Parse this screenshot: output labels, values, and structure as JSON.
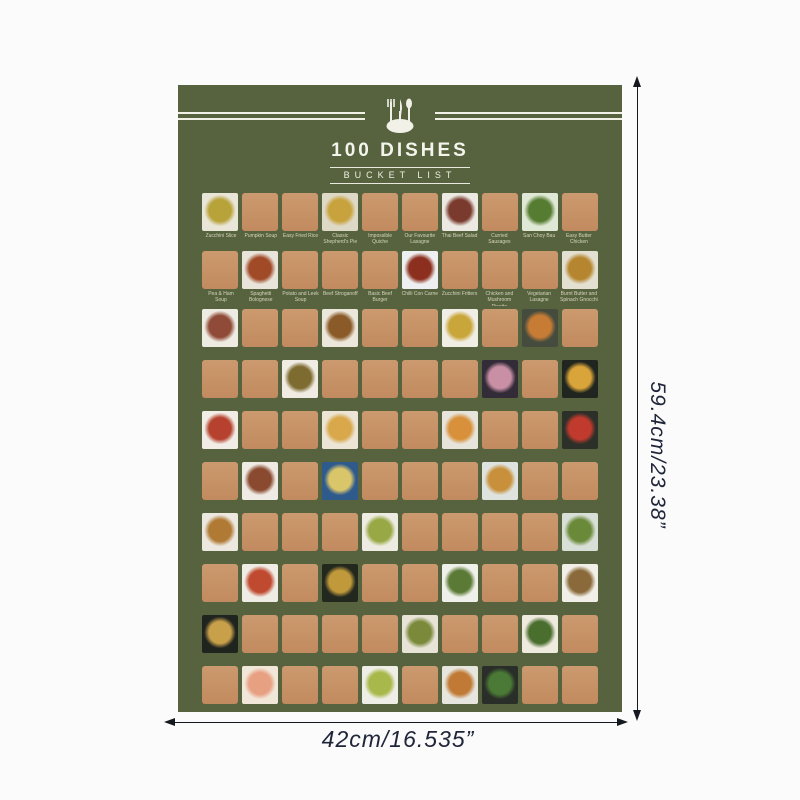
{
  "header": {
    "title": "100 DISHES",
    "subtitle": "BUCKET  LIST",
    "icon": "cutlery-plate-icon"
  },
  "annotations": {
    "height_label": "59.4cm/23.38”",
    "width_label": "42cm/16.535”"
  },
  "colors": {
    "poster_bg": "#57633f",
    "scratch": "#c28a5f",
    "label": "#d6d6bc",
    "annotation": "#20263a",
    "header_text": "#f4f4ec"
  },
  "grid": {
    "rows": [
      {
        "labeled": true,
        "cells": [
          {
            "t": "photo",
            "label": "Zucchini Slice",
            "desc": "zucchini-slice",
            "bg": "#e9e6d8",
            "food": "#b8a23a"
          },
          {
            "t": "scratch",
            "label": "Pumpkin Soup"
          },
          {
            "t": "scratch",
            "label": "Easy Fried Rice"
          },
          {
            "t": "photo",
            "label": "Classic Shepherd's Pie",
            "desc": "shepherds-pie",
            "bg": "#ded8c6",
            "food": "#c8a23c"
          },
          {
            "t": "scratch",
            "label": "Impossible Quiche"
          },
          {
            "t": "scratch",
            "label": "Our Favourite Lasagne"
          },
          {
            "t": "photo",
            "label": "Thai Beef Salad",
            "desc": "thai-beef-salad",
            "bg": "#ebe9e2",
            "food": "#7a3b2e"
          },
          {
            "t": "scratch",
            "label": "Curried Sausages"
          },
          {
            "t": "photo",
            "label": "San Choy Bau",
            "desc": "san-choy-bau",
            "bg": "#dfe8d4",
            "food": "#557c31"
          },
          {
            "t": "scratch",
            "label": "Easy Butter Chicken"
          }
        ]
      },
      {
        "labeled": true,
        "cells": [
          {
            "t": "scratch",
            "label": "Pea & Ham Soup"
          },
          {
            "t": "photo",
            "label": "Spaghetti Bolognese",
            "desc": "spaghetti-bolognese",
            "bg": "#e8e4da",
            "food": "#a04a28"
          },
          {
            "t": "scratch",
            "label": "Potato and Leek Soup"
          },
          {
            "t": "scratch",
            "label": "Beef Stroganoff"
          },
          {
            "t": "scratch",
            "label": "Basic Beef Burger"
          },
          {
            "t": "photo",
            "label": "Chilli Con Carne",
            "desc": "chilli-con-carne",
            "bg": "#edeff0",
            "food": "#8c2f1e"
          },
          {
            "t": "scratch",
            "label": "Zucchini Fritters"
          },
          {
            "t": "scratch",
            "label": "Chicken and Mushroom Risotto"
          },
          {
            "t": "scratch",
            "label": "Vegetarian Lasagne"
          },
          {
            "t": "photo",
            "label": "Burnt Butter and Spinach Gnocchi",
            "desc": "spinach-gnocchi",
            "bg": "#e3e0d2",
            "food": "#b5862f"
          }
        ]
      },
      {
        "labeled": false,
        "cells": [
          {
            "t": "photo",
            "desc": "garden-salad",
            "bg": "#eeebe2",
            "food": "#8f4a38"
          },
          {
            "t": "scratch"
          },
          {
            "t": "scratch"
          },
          {
            "t": "photo",
            "desc": "fried-noodles",
            "bg": "#ece7db",
            "food": "#8a5a28"
          },
          {
            "t": "scratch"
          },
          {
            "t": "scratch"
          },
          {
            "t": "photo",
            "desc": "corn-salad",
            "bg": "#f0ede4",
            "food": "#c9a63a"
          },
          {
            "t": "scratch"
          },
          {
            "t": "photo",
            "desc": "roast-veggie-bowl",
            "bg": "#454c3e",
            "food": "#c77c35"
          },
          {
            "t": "scratch"
          }
        ]
      },
      {
        "labeled": false,
        "cells": [
          {
            "t": "scratch"
          },
          {
            "t": "scratch"
          },
          {
            "t": "photo",
            "desc": "spaghetti-plate",
            "bg": "#f0ece4",
            "food": "#7d6b30"
          },
          {
            "t": "scratch"
          },
          {
            "t": "scratch"
          },
          {
            "t": "scratch"
          },
          {
            "t": "scratch"
          },
          {
            "t": "photo",
            "desc": "berry-cheesecake",
            "bg": "#332c38",
            "food": "#c98fa5"
          },
          {
            "t": "scratch"
          },
          {
            "t": "photo",
            "desc": "loaded-nacho-pan",
            "bg": "#20261f",
            "food": "#d9a43a"
          }
        ]
      },
      {
        "labeled": false,
        "cells": [
          {
            "t": "photo",
            "desc": "meat-platter",
            "bg": "#f1ede6",
            "food": "#b5412e"
          },
          {
            "t": "scratch"
          },
          {
            "t": "scratch"
          },
          {
            "t": "photo",
            "desc": "quiche",
            "bg": "#ece5d6",
            "food": "#d8a84a"
          },
          {
            "t": "scratch"
          },
          {
            "t": "scratch"
          },
          {
            "t": "photo",
            "desc": "pasta-bake",
            "bg": "#e7e4dc",
            "food": "#d8913a"
          },
          {
            "t": "scratch"
          },
          {
            "t": "scratch"
          },
          {
            "t": "photo",
            "desc": "dark-tray-pizza",
            "bg": "#2c3028",
            "food": "#c03a2e"
          }
        ]
      },
      {
        "labeled": false,
        "cells": [
          {
            "t": "scratch"
          },
          {
            "t": "photo",
            "desc": "pork-ribs",
            "bg": "#efebe4",
            "food": "#8a4a30"
          },
          {
            "t": "scratch"
          },
          {
            "t": "photo",
            "desc": "iced-drink",
            "bg": "#2e5a8c",
            "food": "#d9c56a"
          },
          {
            "t": "scratch"
          },
          {
            "t": "scratch"
          },
          {
            "t": "scratch"
          },
          {
            "t": "photo",
            "desc": "party-pies",
            "bg": "#dfe3e0",
            "food": "#c8903a"
          },
          {
            "t": "scratch"
          },
          {
            "t": "scratch"
          }
        ]
      },
      {
        "labeled": false,
        "cells": [
          {
            "t": "photo",
            "desc": "creamy-pasta",
            "bg": "#ece8df",
            "food": "#b07a35"
          },
          {
            "t": "scratch"
          },
          {
            "t": "scratch"
          },
          {
            "t": "scratch"
          },
          {
            "t": "photo",
            "desc": "prawn-salad",
            "bg": "#eeece2",
            "food": "#97a845"
          },
          {
            "t": "scratch"
          },
          {
            "t": "scratch"
          },
          {
            "t": "scratch"
          },
          {
            "t": "scratch"
          },
          {
            "t": "photo",
            "desc": "grilled-vegetables",
            "bg": "#d8dfd6",
            "food": "#6a8a3a"
          }
        ]
      },
      {
        "labeled": false,
        "cells": [
          {
            "t": "scratch"
          },
          {
            "t": "photo",
            "desc": "prawn-pasta",
            "bg": "#efece5",
            "food": "#c04a30"
          },
          {
            "t": "scratch"
          },
          {
            "t": "photo",
            "desc": "wok-stir-fry",
            "bg": "#23281f",
            "food": "#c09a3a"
          },
          {
            "t": "scratch"
          },
          {
            "t": "scratch"
          },
          {
            "t": "photo",
            "desc": "beef-broccoli",
            "bg": "#eff0e9",
            "food": "#5a7a35"
          },
          {
            "t": "scratch"
          },
          {
            "t": "scratch"
          },
          {
            "t": "photo",
            "desc": "noodle-bowls",
            "bg": "#f1efe8",
            "food": "#8a6a3a"
          }
        ]
      },
      {
        "labeled": false,
        "cells": [
          {
            "t": "photo",
            "desc": "ramen-bowl",
            "bg": "#20241f",
            "food": "#c8a04a"
          },
          {
            "t": "scratch"
          },
          {
            "t": "scratch"
          },
          {
            "t": "scratch"
          },
          {
            "t": "scratch"
          },
          {
            "t": "photo",
            "desc": "beef-stir-fry",
            "bg": "#e7e3d7",
            "food": "#7a8a3a"
          },
          {
            "t": "scratch"
          },
          {
            "t": "scratch"
          },
          {
            "t": "photo",
            "desc": "bean-salad",
            "bg": "#eeeade",
            "food": "#4a6e2e"
          },
          {
            "t": "scratch"
          }
        ]
      },
      {
        "labeled": false,
        "cells": [
          {
            "t": "scratch"
          },
          {
            "t": "photo",
            "desc": "salmon-salad",
            "bg": "#f1e7d8",
            "food": "#e8a083"
          },
          {
            "t": "scratch"
          },
          {
            "t": "scratch"
          },
          {
            "t": "photo",
            "desc": "pesto-pasta",
            "bg": "#efeee6",
            "food": "#a8b84a"
          },
          {
            "t": "scratch"
          },
          {
            "t": "photo",
            "desc": "veggie-stew-pot",
            "bg": "#e6e6df",
            "food": "#c07a35"
          },
          {
            "t": "photo",
            "desc": "greens-rice-bowl",
            "bg": "#2a2e28",
            "food": "#4a7a35"
          },
          {
            "t": "scratch"
          },
          {
            "t": "scratch"
          }
        ]
      }
    ]
  }
}
